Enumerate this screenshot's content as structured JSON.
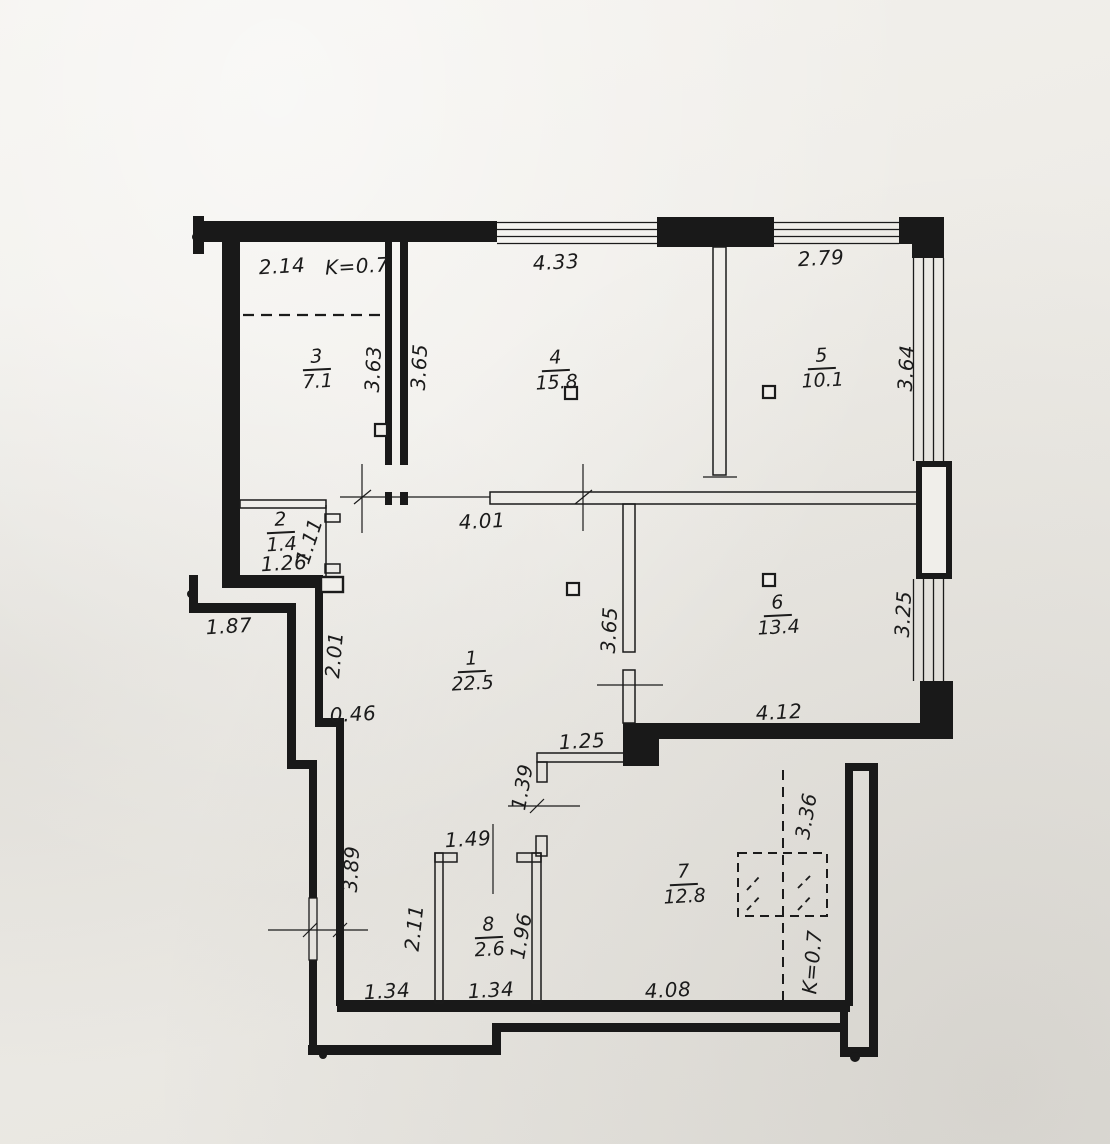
{
  "palette": {
    "paper": "#edebe6",
    "ink": "#1b1b1b"
  },
  "rooms": [
    {
      "number": "1",
      "area": "22.5"
    },
    {
      "number": "2",
      "area": "1.4"
    },
    {
      "number": "3",
      "area": "7.1"
    },
    {
      "number": "4",
      "area": "15.8"
    },
    {
      "number": "5",
      "area": "10.1"
    },
    {
      "number": "6",
      "area": "13.4"
    },
    {
      "number": "7",
      "area": "12.8"
    },
    {
      "number": "8",
      "area": "2.6"
    }
  ],
  "dims": {
    "room3_width": "2.14",
    "k_top": "K=0.7",
    "room4_width": "4.33",
    "room5_width": "2.79",
    "room3_height": "3.63",
    "room4_height": "3.65",
    "room5_height": "3.64",
    "room2_width": "1.26",
    "room2_height": "1.11",
    "room1_width": "4.01",
    "ledge_width": "1.87",
    "ledge_height": "2.01",
    "step_width": "0.46",
    "hall_partition_height": "3.65",
    "room6_height": "3.25",
    "room6_width": "4.12",
    "hall_width": "1.25",
    "hall_opening_height": "1.39",
    "room8_top_width": "1.49",
    "left_wall_height": "3.89",
    "corridor_height": "2.11",
    "room8_inner_height": "1.96",
    "loft_height": "3.36",
    "k_bottom": "K=0.7",
    "corridor_width": "1.34",
    "room8_width": "1.34",
    "room7_width": "4.08"
  }
}
